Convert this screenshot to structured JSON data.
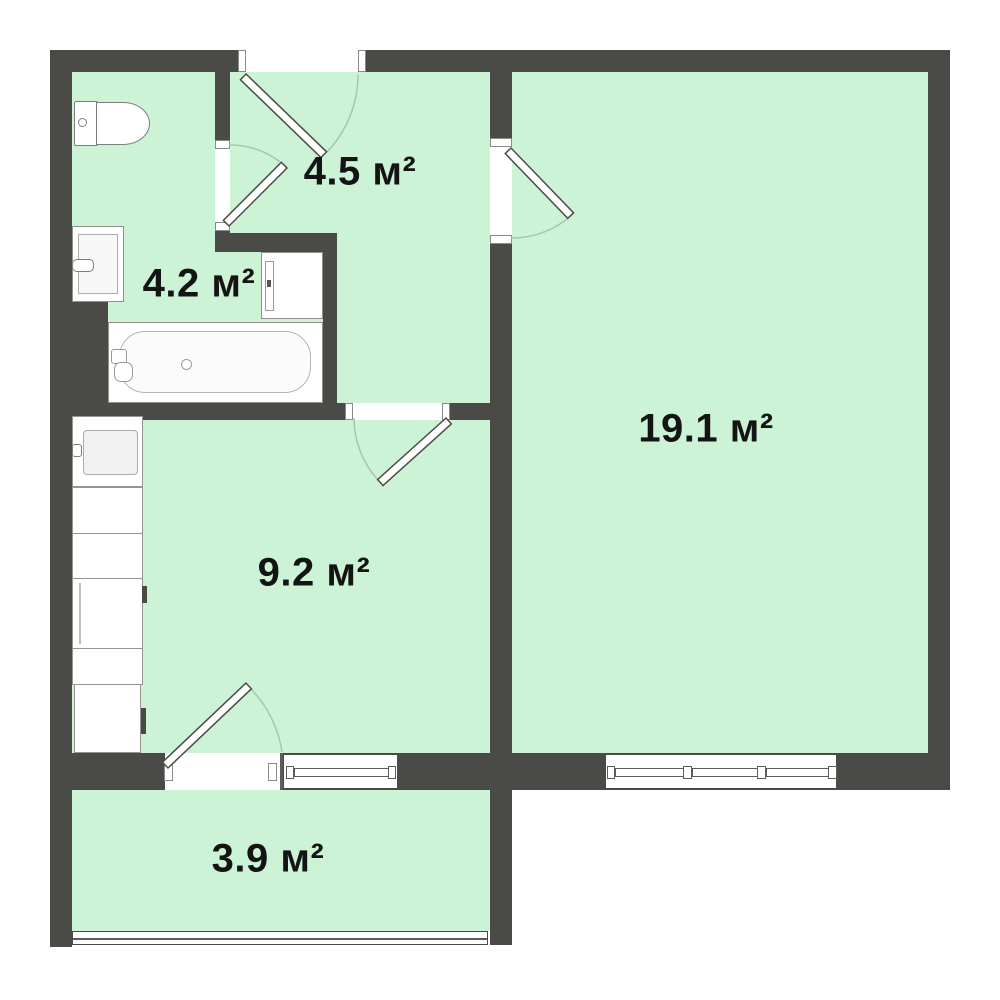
{
  "plan": {
    "type": "floor-plan",
    "unit": "м²",
    "rooms": [
      {
        "name": "hallway",
        "area_label": "4.5 м²"
      },
      {
        "name": "bathroom",
        "area_label": "4.2 м²"
      },
      {
        "name": "living-room",
        "area_label": "19.1 м²"
      },
      {
        "name": "kitchen",
        "area_label": "9.2 м²"
      },
      {
        "name": "balcony",
        "area_label": "3.9 м²"
      }
    ],
    "colors": {
      "wall": "#4a4a47",
      "floor_fill": "#cdf3d7",
      "background": "#ffffff",
      "fixture_outline": "#8f8f8f",
      "door_arc": "#a8c3b0"
    },
    "fixtures": [
      "toilet-icon",
      "bathroom-sink-icon",
      "washing-machine-icon",
      "bathtub-icon",
      "kitchen-sink-icon",
      "kitchen-counter-icon",
      "stove-icon",
      "fridge-icon"
    ],
    "doors_count": 5,
    "windows_count": 3
  }
}
